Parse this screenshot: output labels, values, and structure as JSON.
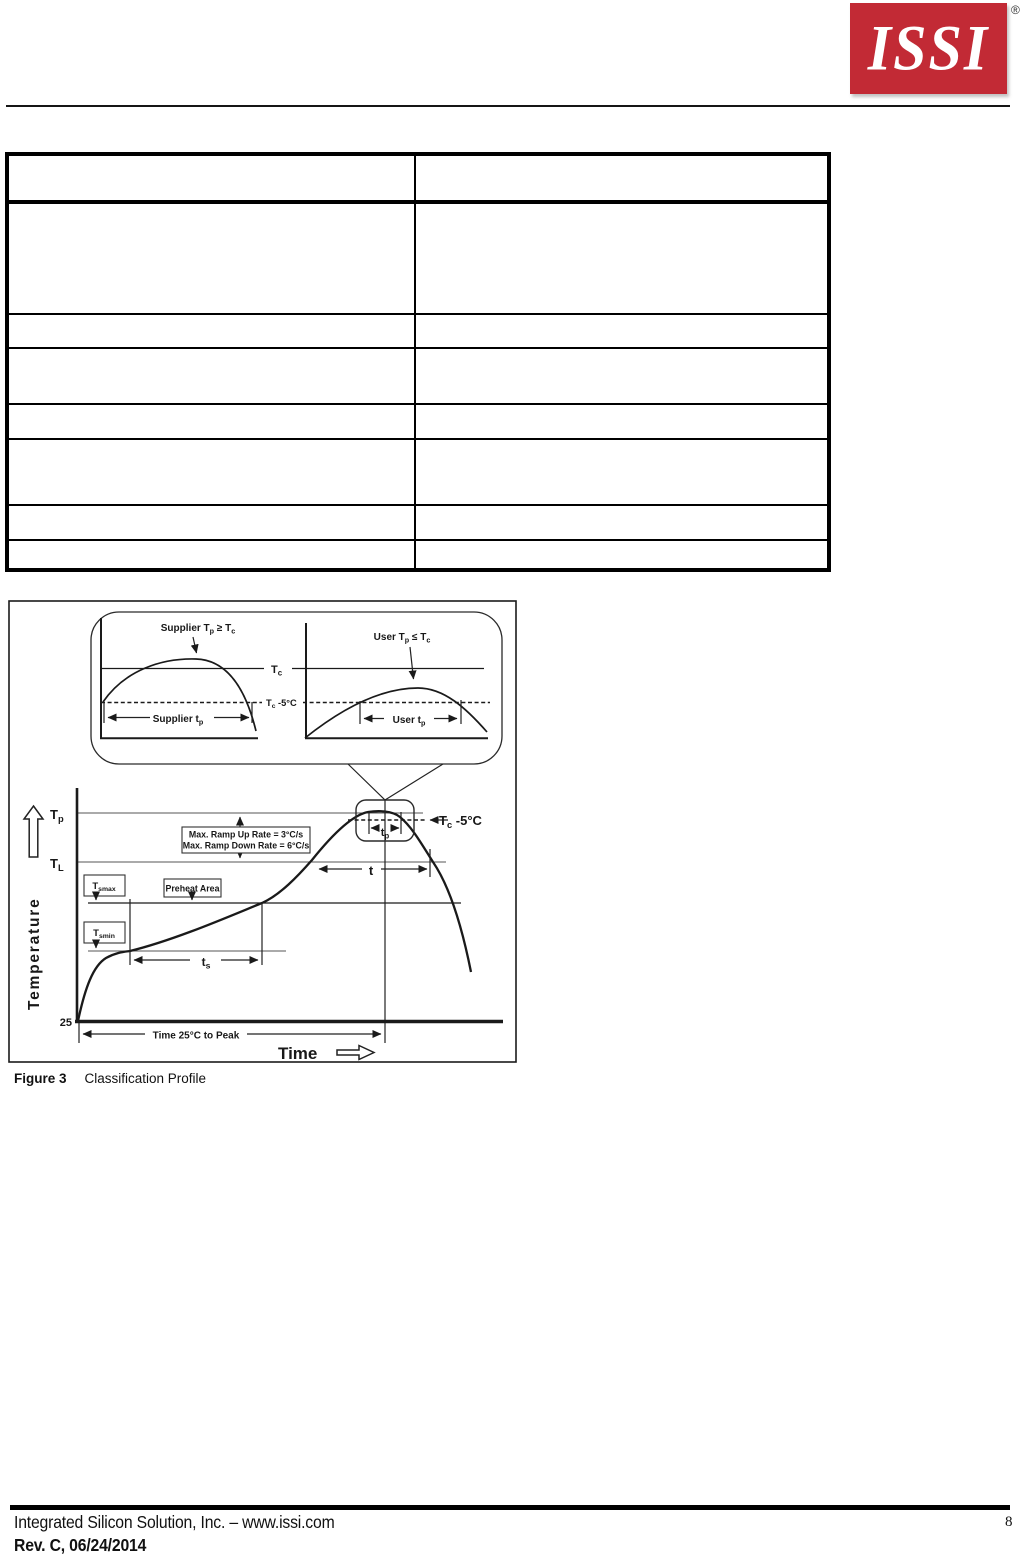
{
  "header": {
    "logo_text": "ISSI",
    "registered_mark": "®"
  },
  "table": {
    "rows": 8,
    "columns": 2
  },
  "figure": {
    "caption_label": "Figure 3",
    "caption_title": "Classification Profile",
    "inset": {
      "supplier_cond": [
        "Supplier T",
        "p",
        " ≥ T",
        "c"
      ],
      "user_cond": [
        "User T",
        "p",
        " ≤ T",
        "c"
      ],
      "tc_label": [
        "T",
        "c"
      ],
      "tc_minus5_label": [
        "T",
        "c",
        " -5°C"
      ],
      "supplier_tp": [
        "Supplier t",
        "p"
      ],
      "user_tp": [
        "User t",
        "p"
      ]
    },
    "main": {
      "tp_label": [
        "T",
        "p"
      ],
      "tl_label": [
        "T",
        "L"
      ],
      "tc_minus5_label": [
        "T",
        "c",
        " -5°C"
      ],
      "tp_span": [
        "t",
        "p"
      ],
      "ramp_up": "Max. Ramp Up Rate = 3°C/s",
      "ramp_down": "Max. Ramp Down Rate = 6°C/s",
      "tsmax_label": [
        "T",
        "smax"
      ],
      "tsmin_label": [
        "T",
        "smin"
      ],
      "preheat_label": "Preheat Area",
      "t_span": "t",
      "ts_span": [
        "t",
        "s"
      ],
      "origin_temp": "25",
      "time_to_peak": "Time 25°C to Peak",
      "x_axis": "Time",
      "y_axis": "Temperature"
    }
  },
  "footer": {
    "company": "Integrated Silicon Solution, Inc. – www.issi.com",
    "revision": "Rev. C, 06/24/2014",
    "page_number": "8"
  }
}
